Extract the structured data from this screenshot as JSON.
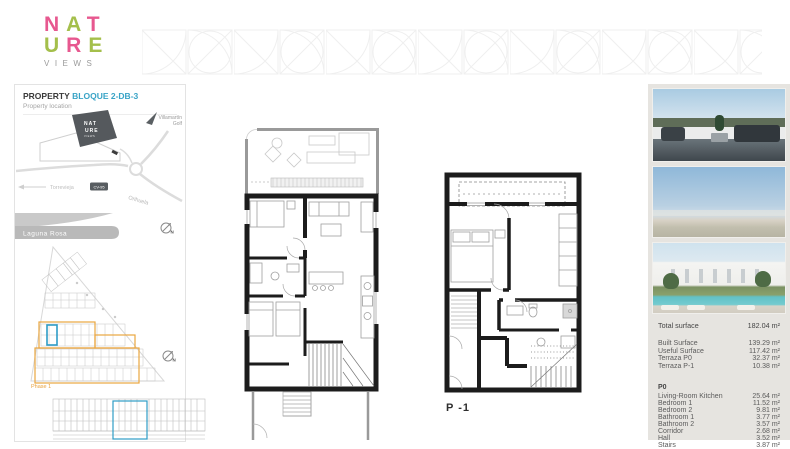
{
  "colors": {
    "brand_pink": "#e7588f",
    "brand_green": "#a4bf4b",
    "accent_teal": "#38a3c6",
    "phase_orange": "#e8a23e",
    "highlight_blue": "#2e9cc6"
  },
  "brand": {
    "line1": [
      "N",
      "A",
      "T"
    ],
    "line2": [
      "U",
      "R",
      "E"
    ],
    "tagline": "VIEWS"
  },
  "panel": {
    "title": "PROPERTY",
    "block": "BLOQUE 2-DB-3",
    "section": "Property location"
  },
  "map": {
    "logo1": "NAT",
    "logo2": "URE",
    "logo3": "VIEWS",
    "villamartin1": "Villamartín",
    "villamartin2": "Golf",
    "torrevieja": "Torrevieja",
    "badge": "CV-95",
    "orihuela": "Orihuela",
    "lagoon": "Laguna Rosa",
    "compass_n": "N"
  },
  "site": {
    "phase": "Phase 1"
  },
  "plans": {
    "p_minus_1": "P -1"
  },
  "details": {
    "total_label": "Total surface",
    "total_value": "182.04 m²",
    "rows": [
      {
        "label": "Built Surface",
        "value": "139.29 m²"
      },
      {
        "label": "Useful Surface",
        "value": "117.42 m²"
      },
      {
        "label": "Terraza P0",
        "value": "32.37 m²"
      },
      {
        "label": "Terraza P-1",
        "value": "10.38 m²"
      }
    ],
    "floor": "P0",
    "rooms": [
      {
        "label": "Living-Room Kitchen",
        "value": "25.64 m²"
      },
      {
        "label": "Bedroom 1",
        "value": "11.52 m²"
      },
      {
        "label": "Bedroom 2",
        "value": "9.81 m²"
      },
      {
        "label": "Bathroom 1",
        "value": "3.77 m²"
      },
      {
        "label": "Bathroom 2",
        "value": "3.57 m²"
      },
      {
        "label": "Corridor",
        "value": "2.68 m²"
      },
      {
        "label": "Hall",
        "value": "3.52 m²"
      },
      {
        "label": "Stairs",
        "value": "3.87 m²"
      }
    ]
  }
}
